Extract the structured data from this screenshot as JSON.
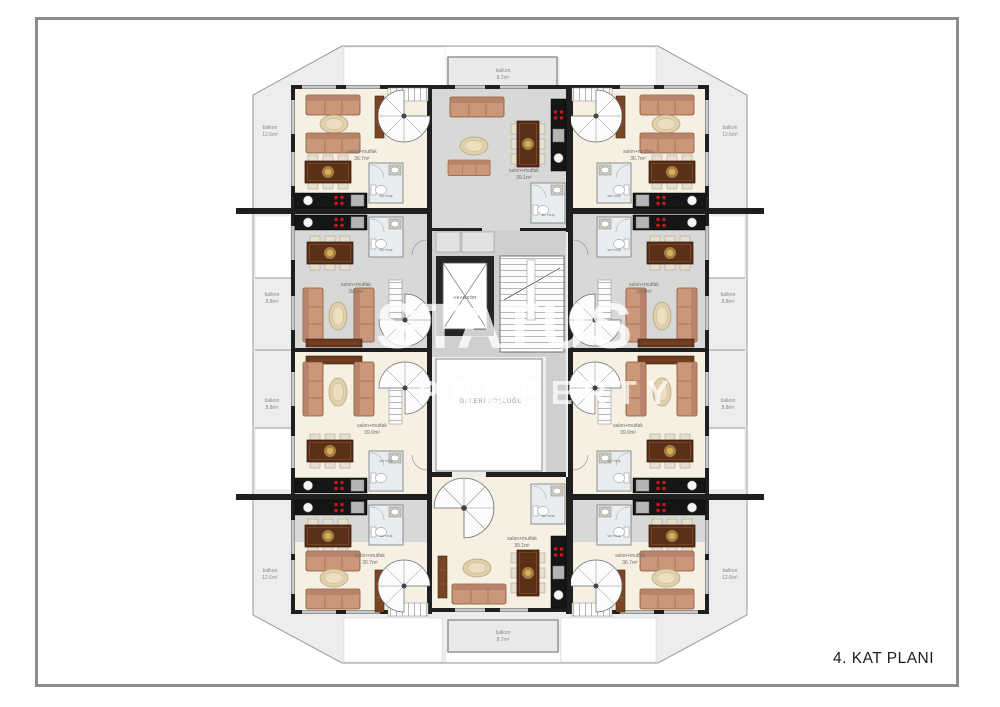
{
  "page": {
    "title": "4. KAT PLANI"
  },
  "watermark": {
    "line1": "STATUS",
    "line2": "PROPERTY"
  },
  "core": {
    "elevator": "ASANSÖR",
    "gallery": "GALERİ BOŞLUĞU"
  },
  "bathroom_label": "wc+duş",
  "rooms": [
    {
      "id": "top-left",
      "label": "salon+mutfak",
      "area": "36.7m²"
    },
    {
      "id": "top-center",
      "label": "salon+mutfak",
      "area": "39.1m²"
    },
    {
      "id": "top-right",
      "label": "salon+mutfak",
      "area": "36.7m²"
    },
    {
      "id": "mid-left-upper",
      "label": "salon+mutfak",
      "area": "39.0m²"
    },
    {
      "id": "mid-right-upper",
      "label": "salon+mutfak",
      "area": "39.0m²"
    },
    {
      "id": "mid-left-lower",
      "label": "salon+mutfak",
      "area": "39.0m²"
    },
    {
      "id": "mid-right-lower",
      "label": "salon+mutfak",
      "area": "39.0m²"
    },
    {
      "id": "bottom-left",
      "label": "salon+mutfak",
      "area": "36.7m²"
    },
    {
      "id": "bottom-center",
      "label": "salon+mutfak",
      "area": "39.1m²"
    },
    {
      "id": "bottom-right",
      "label": "salon+mutfak",
      "area": "36.7m²"
    }
  ],
  "balconies": [
    {
      "id": "top",
      "label": "balkon",
      "area": "8.7m²"
    },
    {
      "id": "bottom",
      "label": "balkon",
      "area": "8.7m²"
    },
    {
      "id": "left-top",
      "label": "balkon",
      "area": "12.6m²"
    },
    {
      "id": "left-mid-upper",
      "label": "balkon",
      "area": "8.8m²"
    },
    {
      "id": "left-mid-lower",
      "label": "balkon",
      "area": "8.8m²"
    },
    {
      "id": "left-bottom",
      "label": "balkon",
      "area": "12.6m²"
    },
    {
      "id": "right-top",
      "label": "balkon",
      "area": "12.6m²"
    },
    {
      "id": "right-mid-upper",
      "label": "balkon",
      "area": "8.8m²"
    },
    {
      "id": "right-mid-lower",
      "label": "balkon",
      "area": "8.8m²"
    },
    {
      "id": "right-bottom",
      "label": "balkon",
      "area": "12.6m²"
    }
  ],
  "colors": {
    "wall": "#1f1f1f",
    "floor_cream": "#f5f0e1",
    "floor_gray": "#d8d8d6",
    "terrace_gray": "#ededed",
    "sofa": "#cb9779",
    "table_wood": "#5c2f17",
    "burner_red": "#d01616",
    "frame_gray": "#8c8c8c"
  }
}
